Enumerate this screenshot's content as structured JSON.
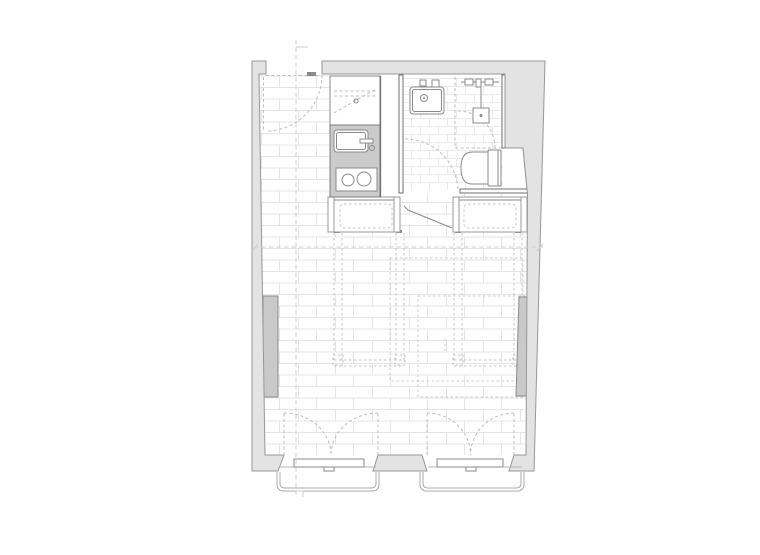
{
  "meta": {
    "title": "studio-apartment-floor-plan",
    "drawing_type": "architectural-plan-top-view",
    "text_labels": []
  },
  "colors": {
    "page_bg": "#ffffff",
    "wall_fill": "#e3e3e3",
    "wall_stroke": "#979797",
    "wall_dark": "#6f6f6f",
    "counter_fill": "#cbcbcb",
    "radiator_fill": "#c9c9c9",
    "fixture_stroke": "#8a8a8a",
    "tile_line": "#e4e4e4",
    "tile_line_small": "#e9e9e9",
    "dash_furniture": "#c6c6c6",
    "dash_arc": "#bdbdbd",
    "section_line": "#cfcfcf",
    "rail_stroke": "#ababab",
    "sill_stroke": "#b3b3b3"
  },
  "rooms": [
    {
      "name": "entry"
    },
    {
      "name": "kitchen"
    },
    {
      "name": "bathroom"
    },
    {
      "name": "main-room"
    }
  ],
  "fixtures": [
    "entry-door-swing",
    "kitchen-upper-cabinet",
    "kitchen-counter",
    "kitchen-sink",
    "kitchen-cooktop",
    "bathroom-sink",
    "shower-head",
    "shower-enclosure",
    "toilet",
    "wall-niche",
    "storage-unit-left",
    "storage-unit-right",
    "fold-down-bed-left",
    "fold-down-bed-right",
    "radiator-left",
    "radiator-right",
    "french-window-left",
    "french-window-right",
    "juliet-balcony-left",
    "juliet-balcony-right",
    "section-line-vertical",
    "section-line-horizontal"
  ]
}
